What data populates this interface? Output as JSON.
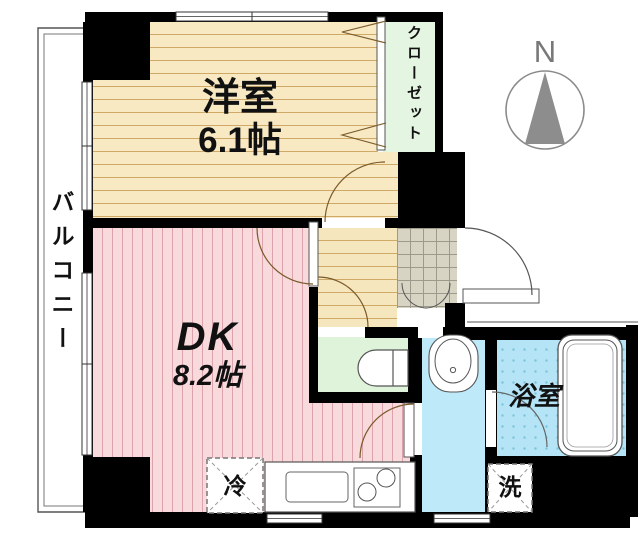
{
  "title": "apartment-floor-plan",
  "compass": {
    "label": "N"
  },
  "rooms": {
    "western": {
      "label": "洋室",
      "size": "6.1帖"
    },
    "dk": {
      "label": "DK",
      "size": "8.2帖"
    },
    "closet": {
      "label": "クローゼット"
    },
    "bath": {
      "label": "浴室"
    },
    "balcony": {
      "label": "バルコニー"
    },
    "fridge": {
      "label": "冷"
    },
    "washer": {
      "label": "洗"
    }
  },
  "fixtures": [
    "bathtub",
    "toilet",
    "washbasin",
    "kitchen-sink",
    "stove",
    "entrance-door",
    "closet-folding-door",
    "compass-north-arrow",
    "balcony-windows",
    "kitchen-counter"
  ],
  "palette": {
    "wall": "#000000",
    "western_room_floor": "#f8e9c3",
    "western_room_lines": "#cfa968",
    "dk_floor": "#f8d9dc",
    "dk_lines": "#dda3ac",
    "closet_fill": "#e4f5e2",
    "toilet_fill": "#dff3da",
    "washroom_fill": "#bee9f8",
    "bath_fill": "#b4e4f5",
    "genkan_tile": "#d8d4c4",
    "door_arc": "#7a5a2a",
    "compass_gray": "#8d8d8d"
  }
}
